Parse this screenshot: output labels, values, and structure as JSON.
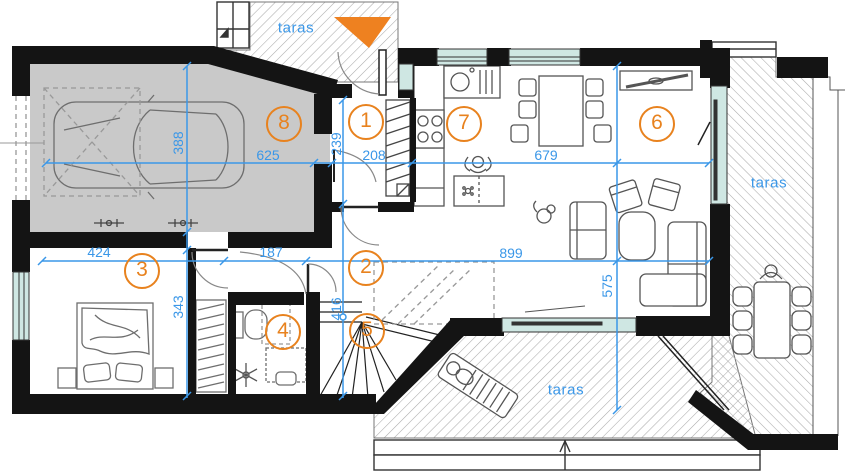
{
  "plan": {
    "type": "architectural-floor-plan",
    "colors": {
      "dimension_blue": "#3a97e8",
      "accent_orange": "#e8821e",
      "wall_black": "#141414",
      "window_teal": "#cfe7e3",
      "garage_gray": "#c9c9c9",
      "hatch_gray": "#ababab"
    },
    "entrance_marker": {
      "shape": "triangle",
      "color": "#ee8120"
    },
    "rooms": [
      {
        "number": "1",
        "x": 366,
        "y": 122
      },
      {
        "number": "2",
        "x": 366,
        "y": 268
      },
      {
        "number": "3",
        "x": 142,
        "y": 271
      },
      {
        "number": "4",
        "x": 283,
        "y": 332
      },
      {
        "number": "5",
        "x": 367,
        "y": 331
      },
      {
        "number": "6",
        "x": 657,
        "y": 124
      },
      {
        "number": "7",
        "x": 464,
        "y": 124
      },
      {
        "number": "8",
        "x": 284,
        "y": 124
      }
    ],
    "dimensions": [
      {
        "value": "625",
        "x": 268,
        "y": 155,
        "rot": 0
      },
      {
        "value": "388",
        "x": 178,
        "y": 143,
        "rot": -90
      },
      {
        "value": "239",
        "x": 336,
        "y": 144,
        "rot": -90
      },
      {
        "value": "208",
        "x": 374,
        "y": 155,
        "rot": 0
      },
      {
        "value": "679",
        "x": 546,
        "y": 155,
        "rot": 0
      },
      {
        "value": "424",
        "x": 99,
        "y": 252,
        "rot": 0
      },
      {
        "value": "187",
        "x": 271,
        "y": 252,
        "rot": 0
      },
      {
        "value": "899",
        "x": 511,
        "y": 253,
        "rot": 0
      },
      {
        "value": "343",
        "x": 178,
        "y": 307,
        "rot": -90
      },
      {
        "value": "416",
        "x": 336,
        "y": 309,
        "rot": -90
      },
      {
        "value": "575",
        "x": 607,
        "y": 286,
        "rot": -90
      }
    ],
    "terrace_labels": [
      {
        "label": "taras",
        "x": 296,
        "y": 28
      },
      {
        "label": "taras",
        "x": 769,
        "y": 183
      },
      {
        "label": "taras",
        "x": 566,
        "y": 390
      }
    ]
  }
}
